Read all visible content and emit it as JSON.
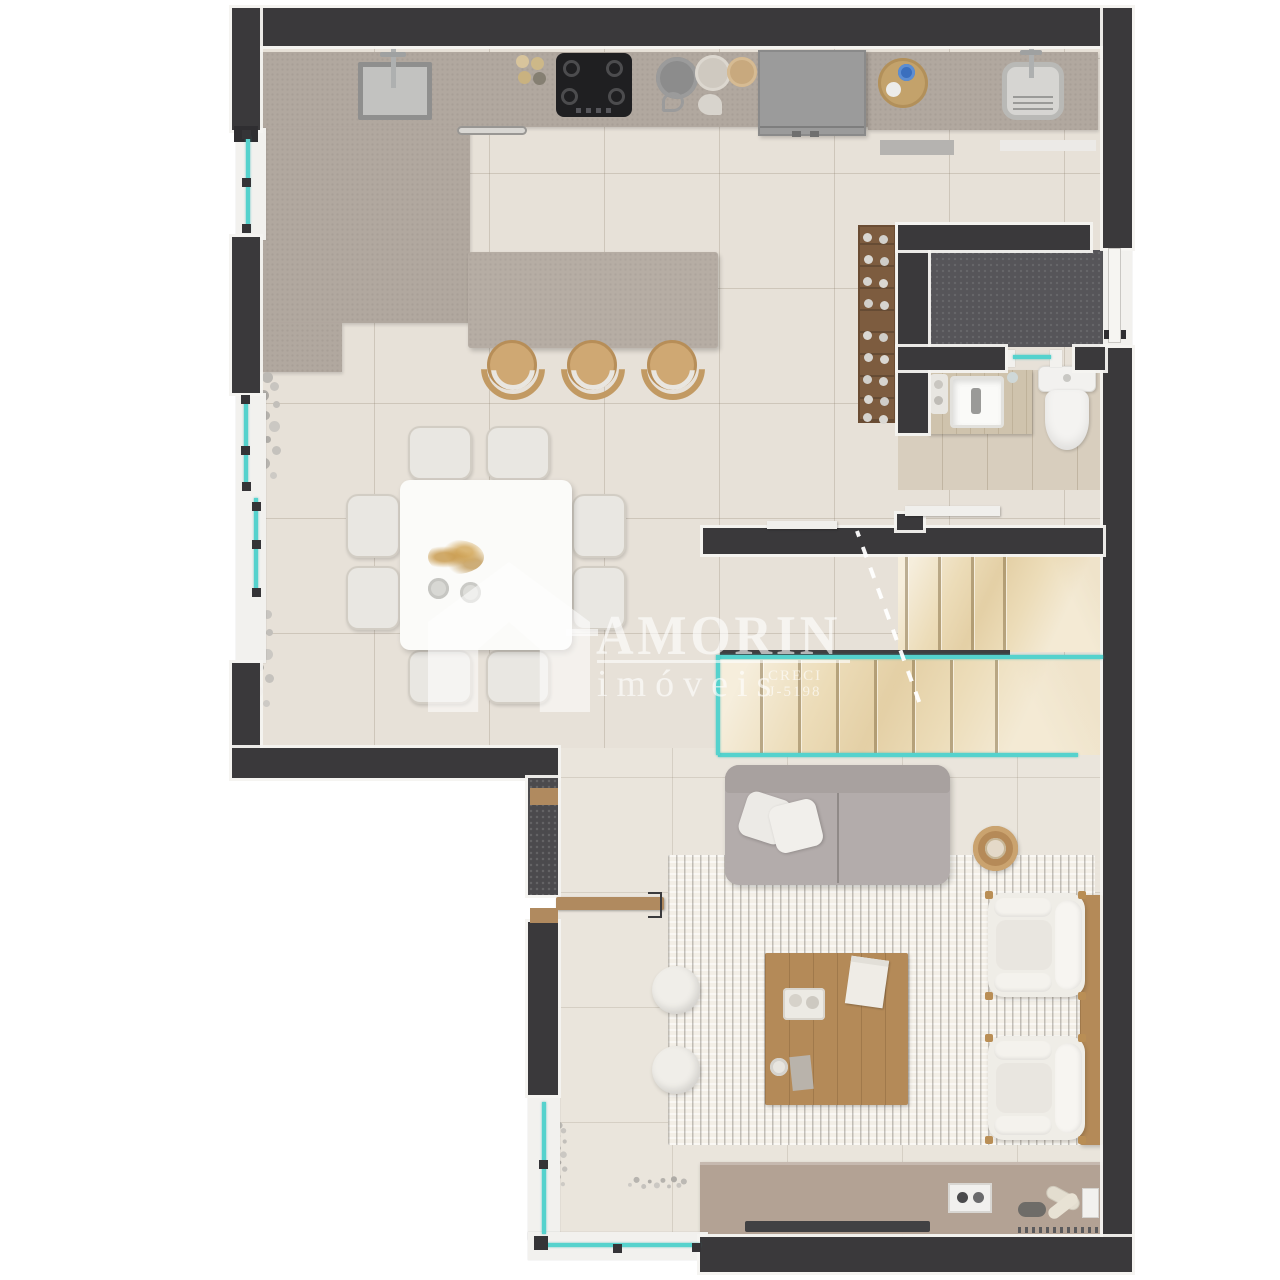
{
  "watermark": {
    "brand": "AMORIN",
    "subtitle": "imóveis",
    "creci_label": "CRECI",
    "creci_number": "J-5198",
    "logo": "house-a-logo"
  },
  "floor_plan": {
    "type": "residential-apartment-top-view-render",
    "rooms": [
      "kitchen",
      "dining-area",
      "living-room",
      "bathroom",
      "storage-room",
      "staircase",
      "laundry-corner"
    ],
    "furniture": [
      "kitchen-counter-with-sink",
      "gas-cooktop",
      "refrigerator",
      "laundry-tank",
      "kitchen-island-with-3-stools",
      "square-dining-table-8-chairs",
      "wine-rack",
      "vanity-sink",
      "toilet",
      "u-shaped-marble-stairs-glass-rail",
      "gray-sofa-with-pillows",
      "round-side-table",
      "two-white-armchairs",
      "wood-coffee-table",
      "two-white-poufs",
      "area-rug",
      "tv-sideboard"
    ],
    "colors": {
      "wall": "#3a393b",
      "trim_white": "#f2f1ee",
      "kitchen_floor": "#e7e1d8",
      "living_floor": "#eae5dc",
      "counter_taupe": "#b1a89f",
      "glass_teal": "#55d2cd",
      "stair_marble": "#ecdcb8",
      "wood_furniture": "#b48a58",
      "sofa_gray": "#b3acab",
      "bath_tile": "#d8cebe",
      "storage_floor": "#565559"
    }
  }
}
